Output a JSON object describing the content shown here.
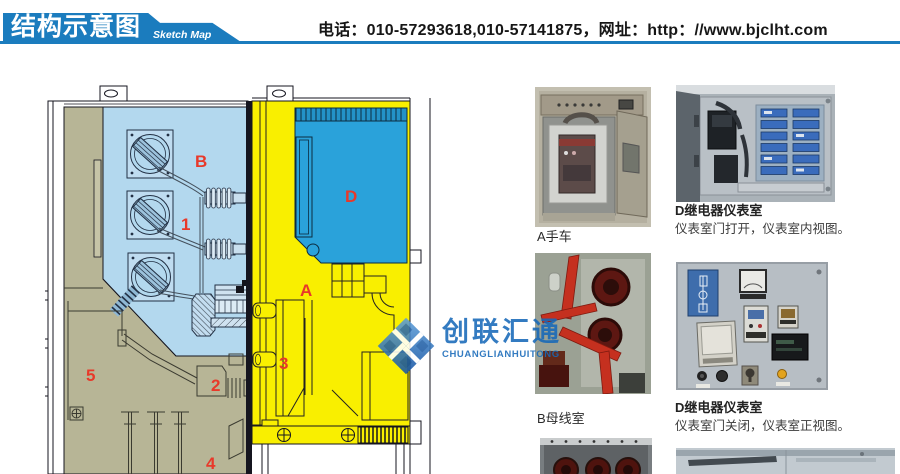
{
  "header": {
    "title": "结构示意图",
    "subtitle": "Sketch Map",
    "contact": "电话：010-57293618,010-57141875，网址：http：//www.bjclht.com"
  },
  "diagram": {
    "zone_labels": {
      "busbar": "B",
      "instrument": "D",
      "breaker": "A",
      "n1": "1",
      "n2": "2",
      "n3": "3",
      "n4": "4",
      "n5": "5"
    }
  },
  "watermark": {
    "name_cn": "创联汇通",
    "name_en": "CHUANGLIANHUITONG"
  },
  "photos": {
    "a_cart": {
      "caption": "A手车"
    },
    "b_busbar": {
      "caption": "B母线室"
    },
    "d_open": {
      "title": "D继电器仪表室",
      "desc": "仪表室门打开，仪表室内视图。"
    },
    "d_closed": {
      "title": "D继电器仪表室",
      "desc": "仪表室门关闭，仪表室正视图。"
    }
  },
  "colors": {
    "accent_blue": "#1b7cbe",
    "zone_busbar_fill": "#b3d8ee",
    "zone_cable_fill": "#b7b596",
    "zone_breaker_fill": "#f9ef00",
    "zone_instrument_fill": "#2aa2da",
    "label_red": "#e8392a",
    "logo_blue": "#1769b9"
  }
}
